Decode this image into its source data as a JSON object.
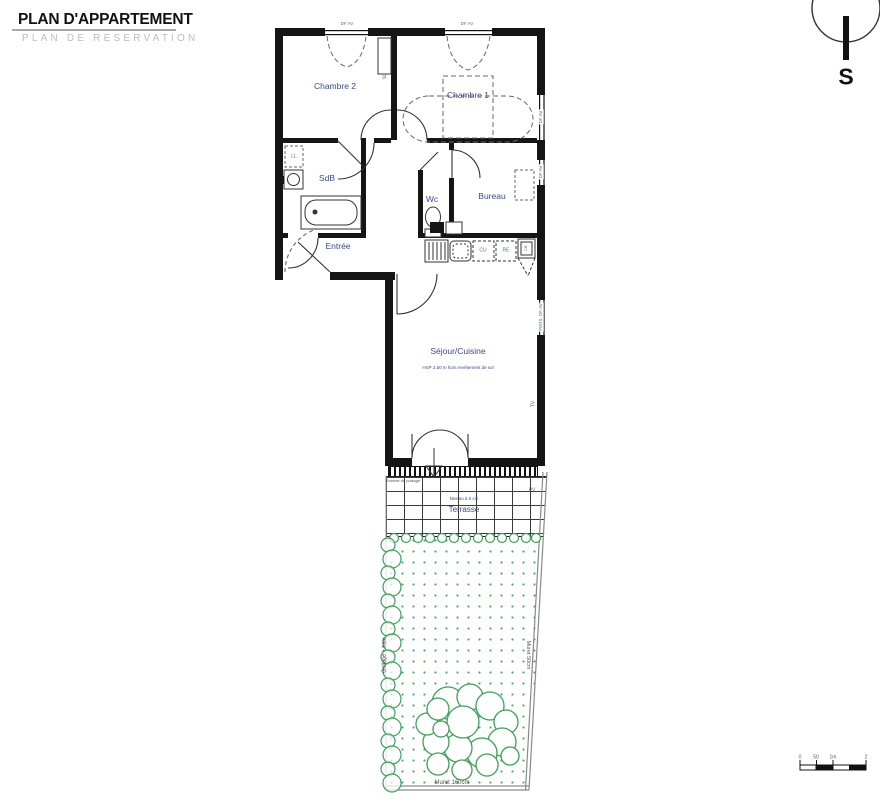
{
  "header": {
    "title": "PLAN D'APPARTEMENT",
    "subtitle": "PLAN DE RESERVATION"
  },
  "compass": {
    "south": "S"
  },
  "rooms": {
    "chambre2": "Chambre 2",
    "chambre1": "Chambre 1",
    "sdb": "SdB",
    "wc": "Wc",
    "bureau": "Bureau",
    "entree": "Entrée",
    "sejour": "Séjour/Cuisine",
    "sejour_note": "HSP 2.50 m hors revêtement de sol",
    "terrasse": "Terrasse",
    "terrasse_note": "Niveau à 5 cm"
  },
  "tags": {
    "placard": "pl.",
    "ll": "LL",
    "cu": "CU",
    "re": "RE",
    "lv": "LV",
    "tv": "TV",
    "pv": "PV",
    "window": "DF AV",
    "window_pers": "PERS. DF AV",
    "tap": "Robinet de puisage"
  },
  "site": {
    "fence_left": "Grillage + haie",
    "wall_right": "Muret 50cm",
    "wall_bottom": "Muret 160cm"
  },
  "scalebar": {
    "t0": "0",
    "t1": "50",
    "t2": "1m",
    "t3": "2"
  },
  "colors": {
    "wall": "#151515",
    "label_blue": "#3b4a80",
    "tag_blue": "#5a6a92",
    "green": "#3f9e58",
    "muted": "#9a9a9a"
  }
}
